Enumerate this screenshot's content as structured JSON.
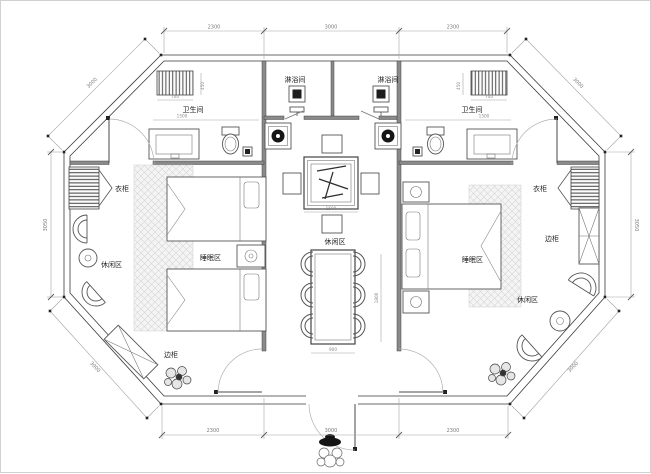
{
  "rooms": {
    "shower_left": "淋浴间",
    "shower_right": "淋浴间",
    "bath_left": "卫生间",
    "bath_right": "卫生间",
    "wardrobe_left": "衣柜",
    "wardrobe_right": "衣柜",
    "sidecab_left": "边柜",
    "sidecab_right": "边柜",
    "leisure_left": "休闲区",
    "leisure_center": "休闲区",
    "leisure_right": "休闲区",
    "sleep_left": "睡眠区",
    "sleep_right": "睡眠区"
  },
  "dims": {
    "top": [
      "2300",
      "3000",
      "2300"
    ],
    "bottom": [
      "2300",
      "3000",
      "2300"
    ],
    "left_side": "3050",
    "right_side": "3050",
    "diag_tl": "3000",
    "diag_tr": "3000",
    "diag_bl": "3000",
    "diag_br": "3000",
    "small": {
      "cab_left_w": "700",
      "cab_right_w": "700",
      "cab_left_h": "450",
      "cab_right_h": "450",
      "bath_left_w": "1500",
      "bath_right_w": "1500",
      "tea_table_w": "1500",
      "dining_h": "1800",
      "dining_w": "900"
    }
  },
  "colors": {
    "wall": "#8f8f8f",
    "line": "#3a3a3a",
    "hatch": "#d4d4d4"
  }
}
